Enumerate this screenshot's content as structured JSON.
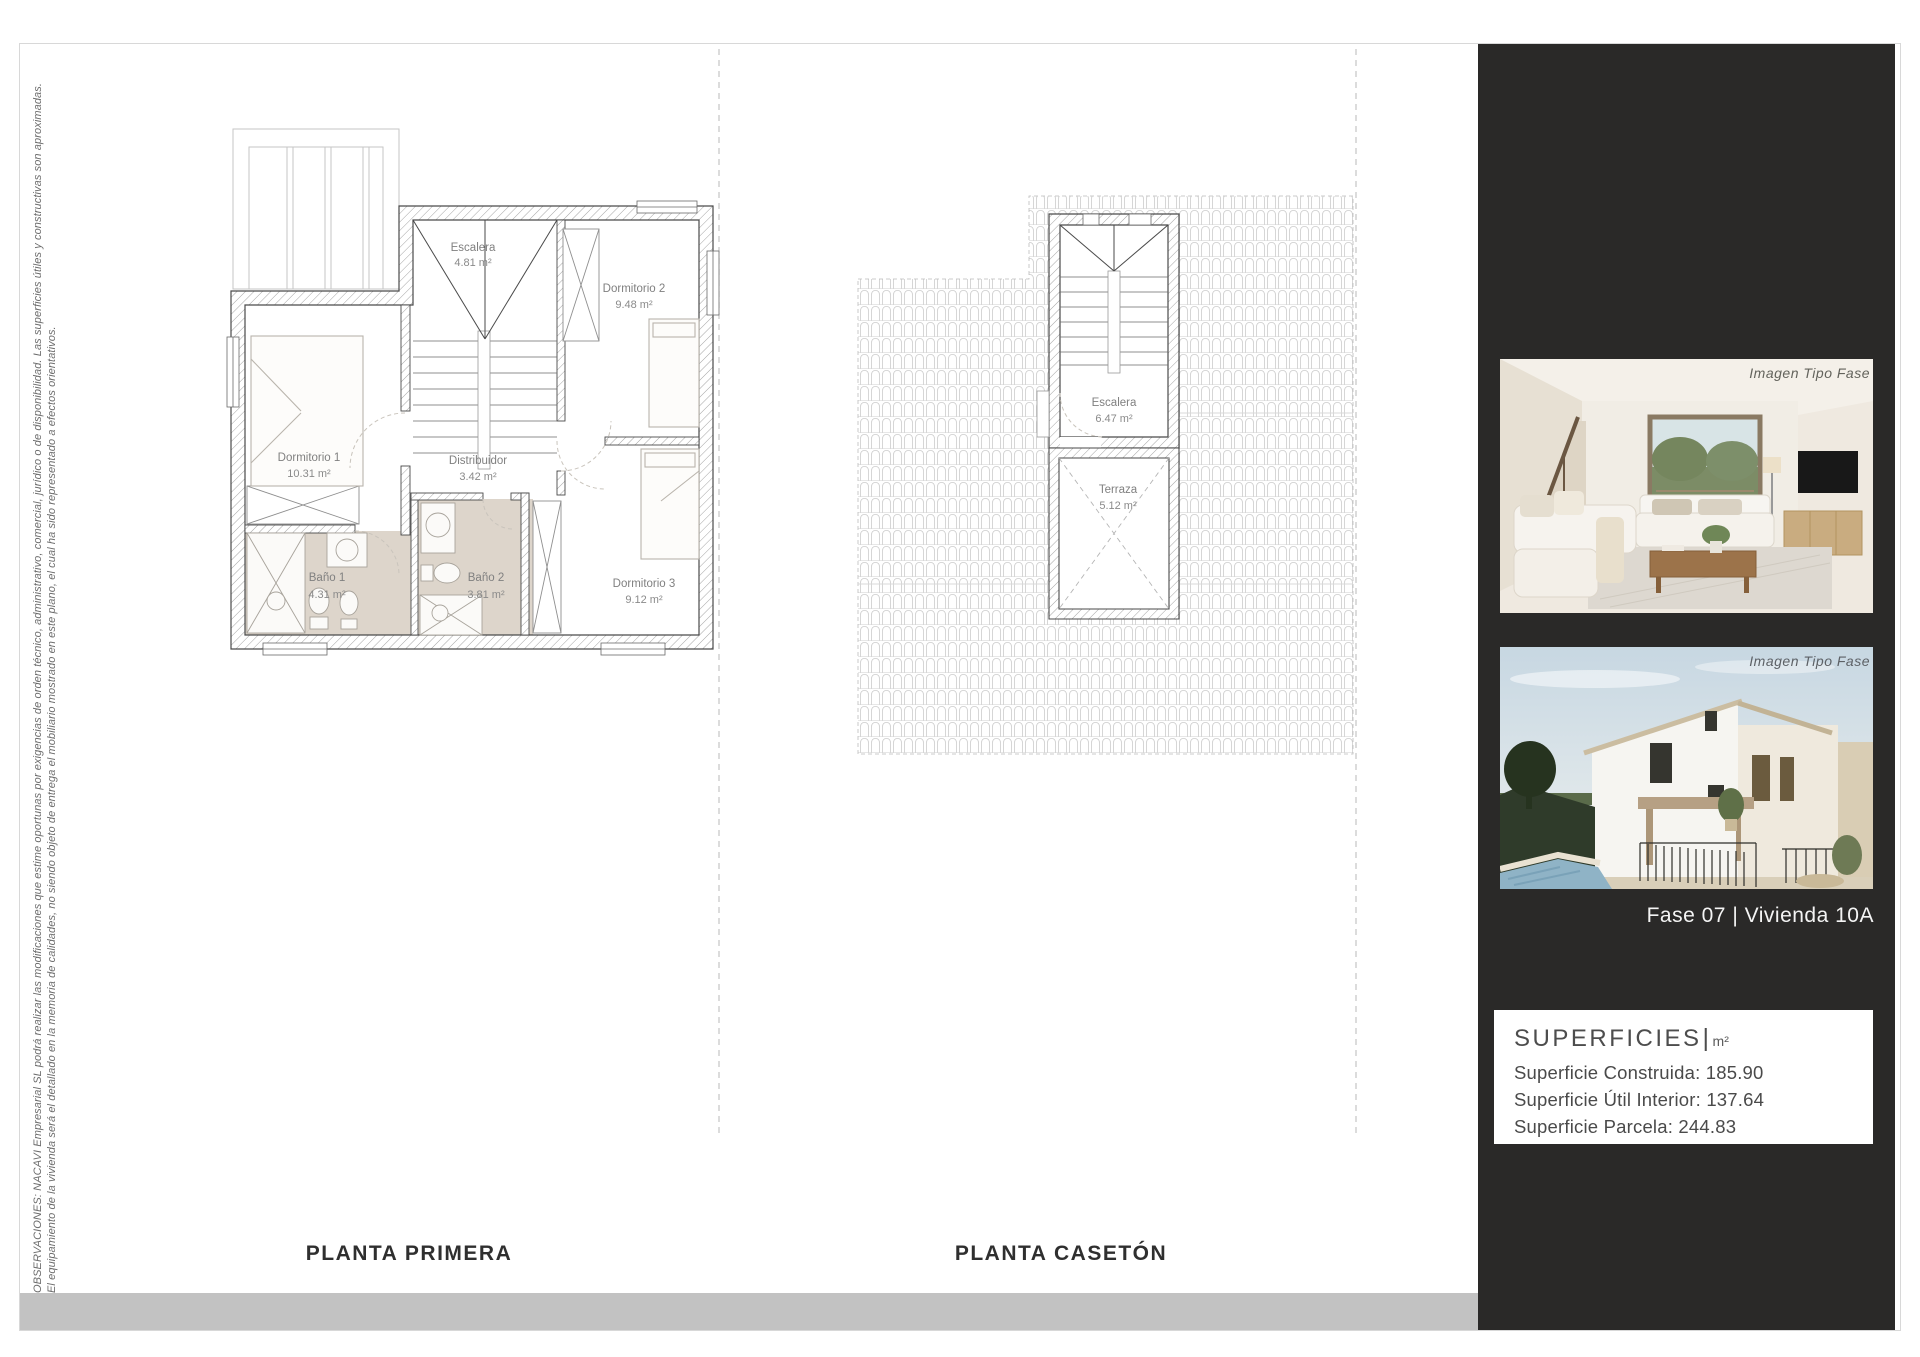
{
  "page": {
    "observations_line1": "OBSERVACIONES: NACAVI Empresarial SL podrá realizar las modificaciones que estime oportunas por exigencias de orden técnico, administrativo, comercial, jurídico o de disponibilidad. Las superficies útiles y constructivas son aproximadas.",
    "observations_line2": "El equipamiento de la vivienda será el detallado en la memoria de calidades, no siendo objeto de entrega el mobiliario mostrado en este plano, el cual ha sido representado a efectos orientativos."
  },
  "plans": {
    "planta_primera": {
      "title": "PLANTA PRIMERA",
      "rooms": [
        {
          "name": "Escalera",
          "area": "4.81 m²"
        },
        {
          "name": "Dormitorio 2",
          "area": "9.48 m²"
        },
        {
          "name": "Dormitorio 1",
          "area": "10.31 m²"
        },
        {
          "name": "Distribuidor",
          "area": "3.42 m²"
        },
        {
          "name": "Baño 1",
          "area": "4.31 m²"
        },
        {
          "name": "Baño 2",
          "area": "3.81 m²"
        },
        {
          "name": "Dormitorio 3",
          "area": "9.12 m²"
        }
      ]
    },
    "planta_caseton": {
      "title": "PLANTA CASETÓN",
      "rooms": [
        {
          "name": "Escalera",
          "area": "6.47 m²"
        },
        {
          "name": "Terraza",
          "area": "5.12 m²"
        }
      ]
    }
  },
  "sidebar": {
    "image1_caption": "Imagen Tipo Fase",
    "image2_caption": "Imagen Tipo Fase",
    "unit_label": "Fase 07 |  Vivienda 10A",
    "superficies": {
      "title": "SUPERFICIES",
      "separator": "|",
      "unit": "m²",
      "items": [
        "Superficie Construida:  185.90",
        "Superficie Útil Interior: 137.64",
        "Superficie Parcela: 244.83"
      ]
    }
  },
  "colors": {
    "sidebar_background": "#2a2928",
    "footer_bar": "#c2c2c2",
    "bath_floor": "#ddd5cb",
    "plan_line_dark": "#4a4a4a",
    "plan_line_light": "#c9c9c9"
  }
}
